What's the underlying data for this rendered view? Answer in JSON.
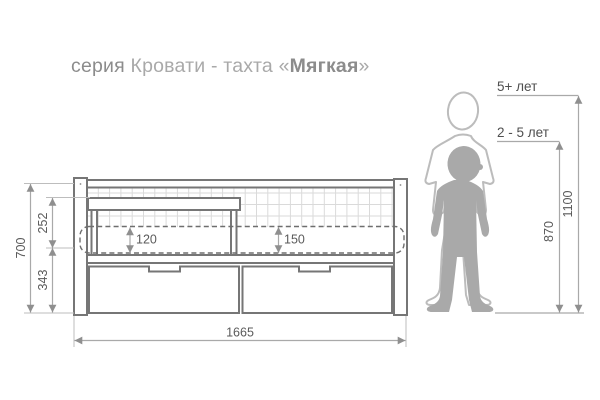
{
  "title": {
    "series": "серия",
    "category": "Кровати - тахта",
    "open_quote": "«",
    "model": "Мягкая",
    "close_quote": "»"
  },
  "bed_dimensions": {
    "total_height": "700",
    "backrest_section_height": "252",
    "base_section_height": "343",
    "mattress_height_option_1": "120",
    "mattress_height_option_2": "150",
    "total_length": "1665"
  },
  "children": {
    "older": {
      "age_label": "5+ лет",
      "height": "1100"
    },
    "younger": {
      "age_label": "2 - 5 лет",
      "height": "870"
    }
  },
  "colors": {
    "drawing_outline": "#767676",
    "grid_mesh": "#dadada",
    "mattress_dash": "#6e6e6e",
    "dimension_line": "#a9a9a9",
    "dimension_text": "#5a5a5a",
    "silhouette_fill": "#a9a9a9",
    "silhouette_outline": "#bcbcbc",
    "title_dark": "#8c8c8c",
    "title_light": "#a9a9a9"
  }
}
